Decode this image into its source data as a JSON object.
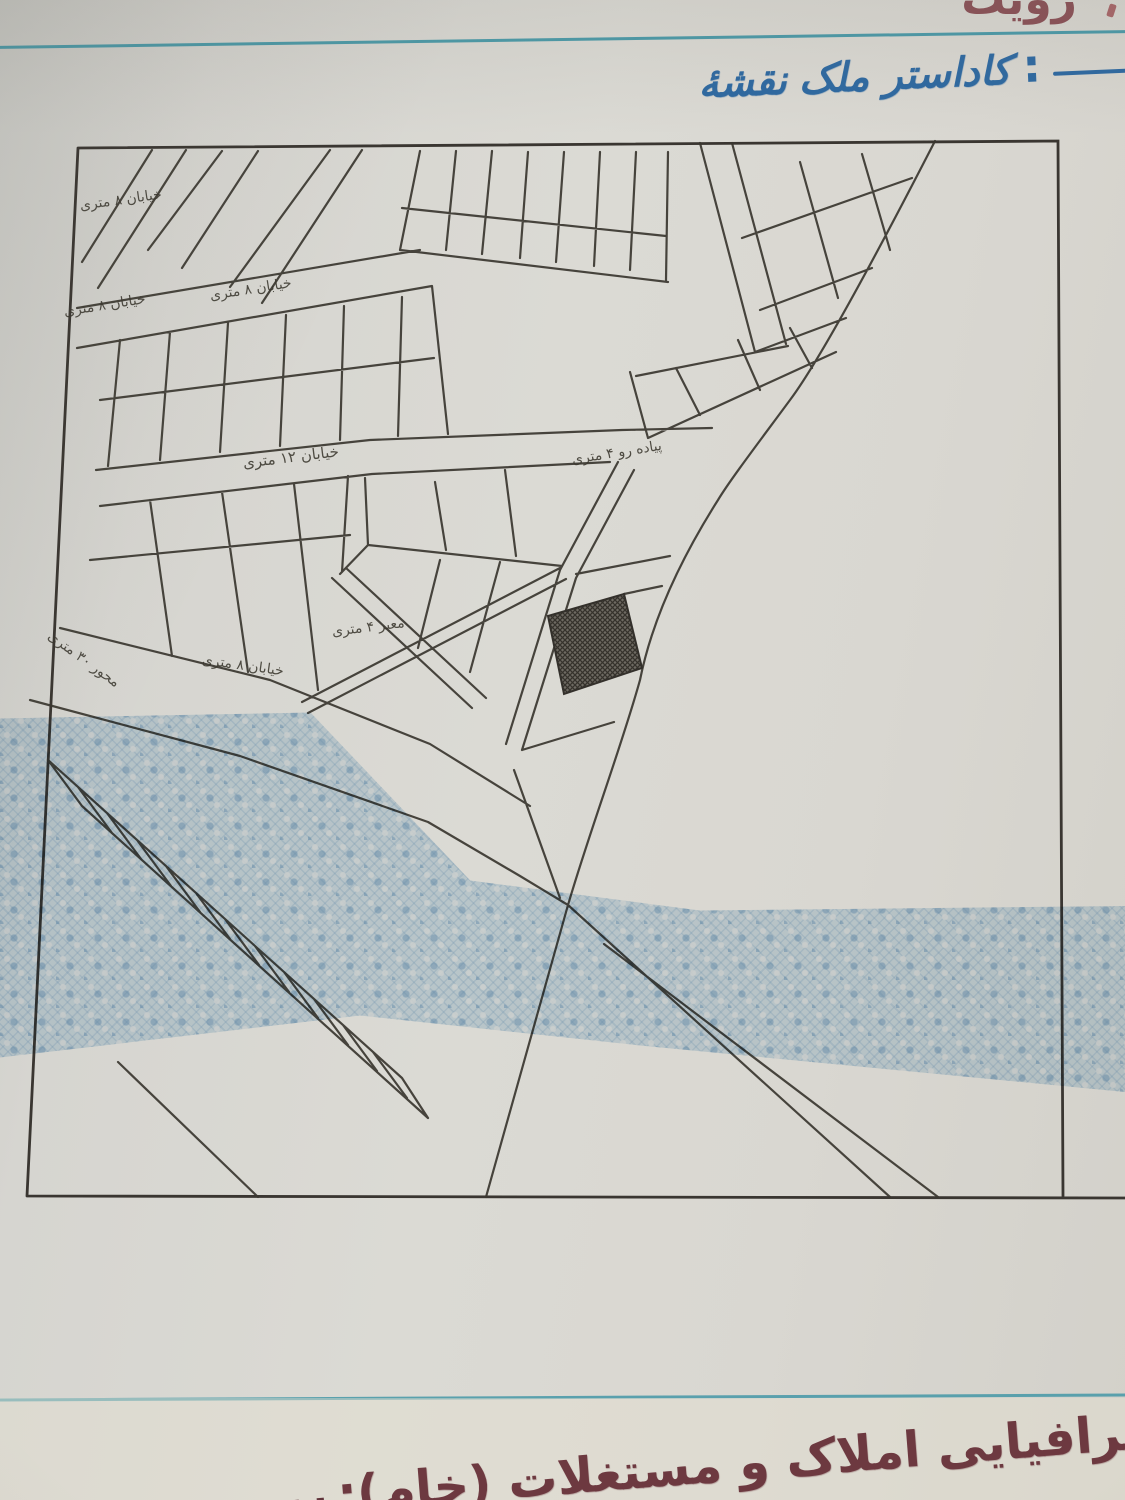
{
  "document": {
    "top_cropped_text": "رؤیت",
    "heading": {
      "word1": "نقشهٔ",
      "word2": "کاداستر ملک",
      "colon": ":"
    },
    "footer": {
      "label": "جغرافیایی املاک و مستغلات (خام):",
      "number": "۴۹۹۴۵۴۳۹۶۹۹۶۱۳۹۰۰۰۰۰۰۰۰۰۰"
    }
  },
  "map": {
    "street_labels": [
      {
        "text": "خیابان ۸ متری"
      },
      {
        "text": "خیابان ۸ متری"
      },
      {
        "text": "خیابان ۸ متری"
      },
      {
        "text": "خیابان ۱۲ متری"
      },
      {
        "text": "پیاده رو ۴ متری"
      },
      {
        "text": "معبر ۴ متری"
      },
      {
        "text": "محور ۳۰ متری"
      },
      {
        "text": "خیابان ۸ متری"
      }
    ]
  },
  "colors": {
    "heading_blue": "#2e69a1",
    "rule_teal": "#4b9aa8",
    "ink": "#38342e",
    "footer_maroon": "#6d3940",
    "watermark_blue": "#9ec4e0"
  }
}
